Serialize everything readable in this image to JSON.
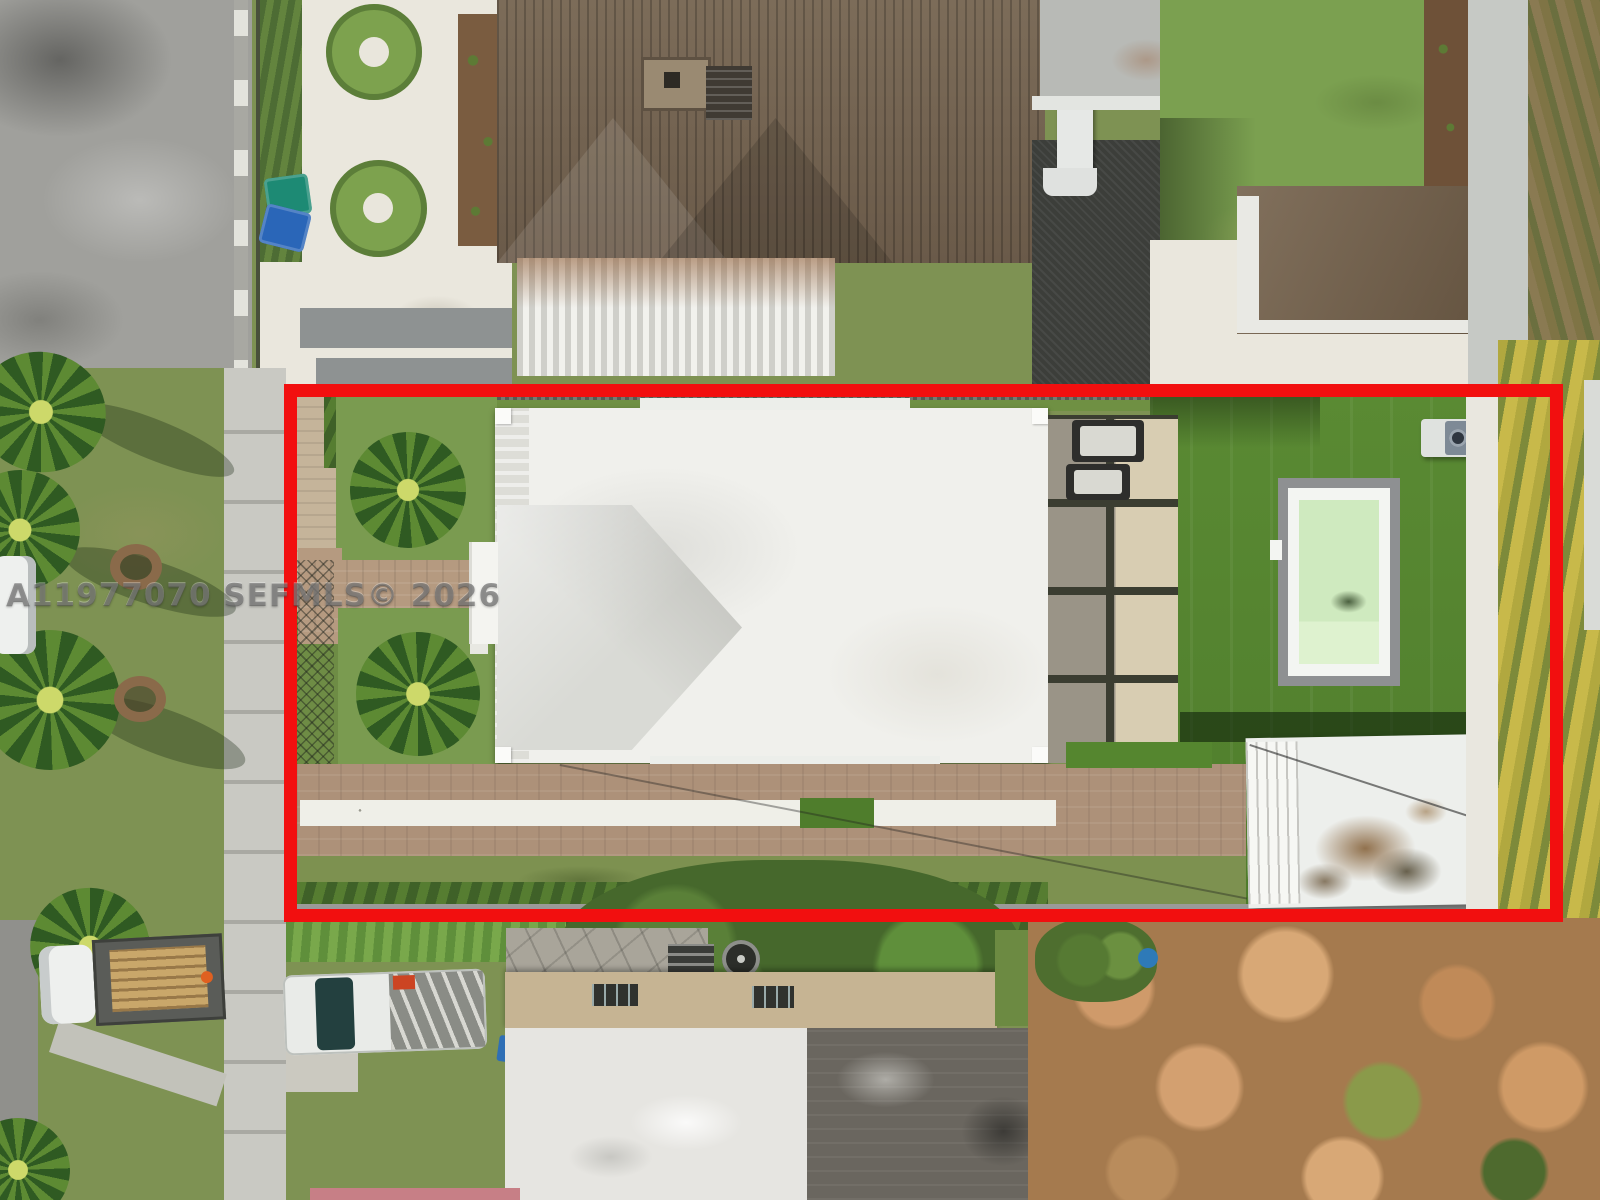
{
  "image": {
    "kind": "aerial-drone-photo",
    "subject": "top-down view of a residential lot with white flat-roof house, artificial-turf backyard, pool and shed, outlined by a red property boundary",
    "width_px": 1600,
    "height_px": 1200
  },
  "watermark": {
    "text": "A11977070 SEFMLS© 2026"
  },
  "overlay": {
    "boundary_color": "#f20f0f",
    "boundary_stroke_px": 13
  },
  "colors": {
    "street_gray": "#a0a09c",
    "gravel_white": "#eae7dd",
    "tile_roof_brown": "#6f6050",
    "awning_white": "#e8e8e4",
    "lawn_green": "#7ba050",
    "front_grass": "#6e8c45",
    "turf_green": "#55862f",
    "house_roof_white": "#f0f0ec",
    "pool_water": "#cfeabf",
    "pool_deck": "#8e9092",
    "driveway_pavers": "#ad9179",
    "shed_brown": "#73604a",
    "shed_white": "#edefec",
    "hedge_yellow": "#b1a83f",
    "autumn_trees_orange": "#c08a58",
    "recycle_bin_blue": "#2a66b8",
    "trash_bin_teal": "#1d8a74"
  },
  "scene_objects": [
    "street",
    "sidewalk",
    "parkway palm trees",
    "white gravel yard with circular hedges",
    "brown tile roof house",
    "corrugated carport awning",
    "brown shed",
    "main house white flat roof",
    "entry walkway",
    "paver patio with lounge chairs",
    "artificial turf backyard",
    "swimming pool",
    "ac unit",
    "paver driveway with gravel strip",
    "white storage shed",
    "golden hedge row",
    "flatbed truck with pallets",
    "pickup truck with ladders",
    "neighbor house flat roof",
    "orange autumn trees",
    "red property boundary overlay",
    "mls watermark"
  ]
}
